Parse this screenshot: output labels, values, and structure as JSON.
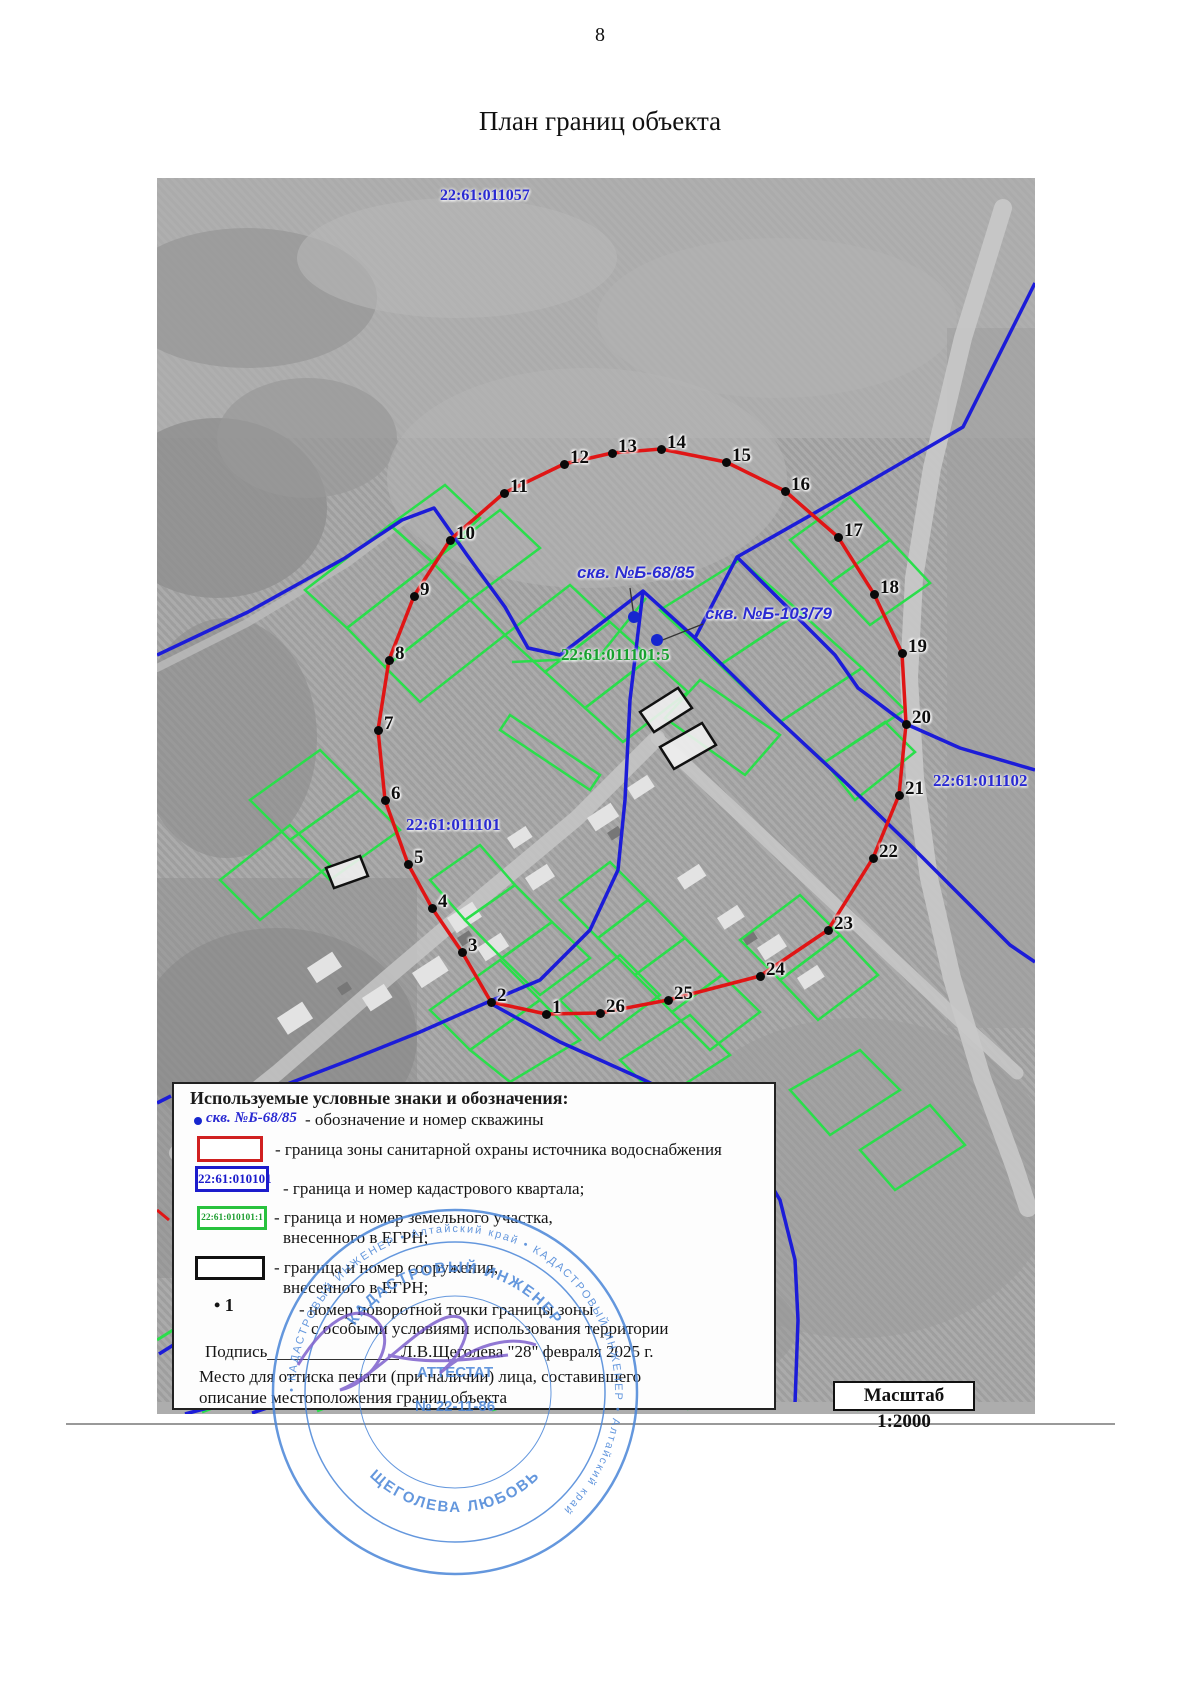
{
  "page": {
    "number": "8",
    "title": "План границ объекта"
  },
  "map": {
    "colors": {
      "zone_red": "#e01515",
      "quarter_blue": "#1c1cd8",
      "parcel_green": "#2ade4b",
      "label_blue": "#2a2ad2",
      "label_green": "#17a12e"
    },
    "labels": [
      {
        "id": "quarter-top",
        "text": "22:61:011057",
        "x": 283,
        "y": 10,
        "color": "#2a2ad2",
        "size": 16,
        "italic": false
      },
      {
        "id": "well-1-label",
        "text": "скв. №Б-68/85",
        "x": 420,
        "y": 386,
        "color": "#2a2ad2",
        "size": 17,
        "italic": true
      },
      {
        "id": "well-2-label",
        "text": "скв. №Б-103/79",
        "x": 548,
        "y": 427,
        "color": "#2a2ad2",
        "size": 17,
        "italic": true
      },
      {
        "id": "parcel-5",
        "text": "22:61:011101:5",
        "x": 404,
        "y": 468,
        "color": "#17a12e",
        "size": 17,
        "italic": false
      },
      {
        "id": "quarter-left",
        "text": "22:61:011101",
        "x": 249,
        "y": 638,
        "color": "#2a2ad2",
        "size": 17,
        "italic": false
      },
      {
        "id": "quarter-right",
        "text": "22:61:011102",
        "x": 776,
        "y": 594,
        "color": "#2a2ad2",
        "size": 17,
        "italic": false
      }
    ],
    "wells": [
      {
        "x": 477,
        "y": 439
      },
      {
        "x": 500,
        "y": 462
      }
    ],
    "boundary_points": [
      {
        "n": "1",
        "x": 389,
        "y": 836
      },
      {
        "n": "2",
        "x": 334,
        "y": 824
      },
      {
        "n": "3",
        "x": 305,
        "y": 774
      },
      {
        "n": "4",
        "x": 275,
        "y": 730
      },
      {
        "n": "5",
        "x": 251,
        "y": 686
      },
      {
        "n": "6",
        "x": 228,
        "y": 622
      },
      {
        "n": "7",
        "x": 221,
        "y": 552
      },
      {
        "n": "8",
        "x": 232,
        "y": 482
      },
      {
        "n": "9",
        "x": 257,
        "y": 418
      },
      {
        "n": "10",
        "x": 293,
        "y": 362
      },
      {
        "n": "11",
        "x": 347,
        "y": 315
      },
      {
        "n": "12",
        "x": 407,
        "y": 286
      },
      {
        "n": "13",
        "x": 455,
        "y": 275
      },
      {
        "n": "14",
        "x": 504,
        "y": 271
      },
      {
        "n": "15",
        "x": 569,
        "y": 284
      },
      {
        "n": "16",
        "x": 628,
        "y": 313
      },
      {
        "n": "17",
        "x": 681,
        "y": 359
      },
      {
        "n": "18",
        "x": 717,
        "y": 416
      },
      {
        "n": "19",
        "x": 745,
        "y": 475
      },
      {
        "n": "20",
        "x": 749,
        "y": 546
      },
      {
        "n": "21",
        "x": 742,
        "y": 617
      },
      {
        "n": "22",
        "x": 716,
        "y": 680
      },
      {
        "n": "23",
        "x": 671,
        "y": 752
      },
      {
        "n": "24",
        "x": 603,
        "y": 798
      },
      {
        "n": "25",
        "x": 511,
        "y": 822
      },
      {
        "n": "26",
        "x": 443,
        "y": 835
      }
    ]
  },
  "legend": {
    "title": "Используемые условные знаки и обозначения:",
    "items": [
      {
        "symbol": "well",
        "symbol_label": "скв. №Б-68/85",
        "text": "- обозначение и номер скважины"
      },
      {
        "symbol": "red-box",
        "text": "- граница зоны санитарной охраны источника водоснабжения"
      },
      {
        "symbol": "blue-box",
        "symbol_label": "22:61:010101",
        "text": "- граница и номер кадастрового квартала;"
      },
      {
        "symbol": "green-box",
        "symbol_label": "22:61:010101:1",
        "text": "- граница  и номер земельного участка,",
        "text2": "внесенного в ЕГРН;"
      },
      {
        "symbol": "black-box",
        "text": "- граница  и номер сооружения,",
        "text2": "внесенного в ЕГРН;"
      },
      {
        "symbol": "point",
        "symbol_label": "• 1",
        "text": "- номер поворотной точки границы зоны",
        "text2": "с особыми условиями использования территории"
      }
    ],
    "signature": {
      "label": "Подпись",
      "value": "Л.В.Щеголева \"28\" февраля 2025 г."
    },
    "note_line1": "Место для оттиска печати (при наличии) лица, составившего",
    "note_line2": "описание местоположения границ объекта"
  },
  "scale_label": "Масштаб 1:2000",
  "stamp": {
    "outer_text": "• КАДАСТРОВЫЙ ИНЖЕНЕР • Алтайский край • КАДАСТРОВЫЙ ИНЖЕНЕР • Алтайский край",
    "arc_top": "КАДАСТРОВЫЙ ИНЖЕНЕР",
    "arc_bottom": "ЩЕГОЛЕВА ЛЮБОВЬ",
    "center_line1": "АТТЕСТАТ",
    "center_line2": "№ 22-11-86"
  }
}
